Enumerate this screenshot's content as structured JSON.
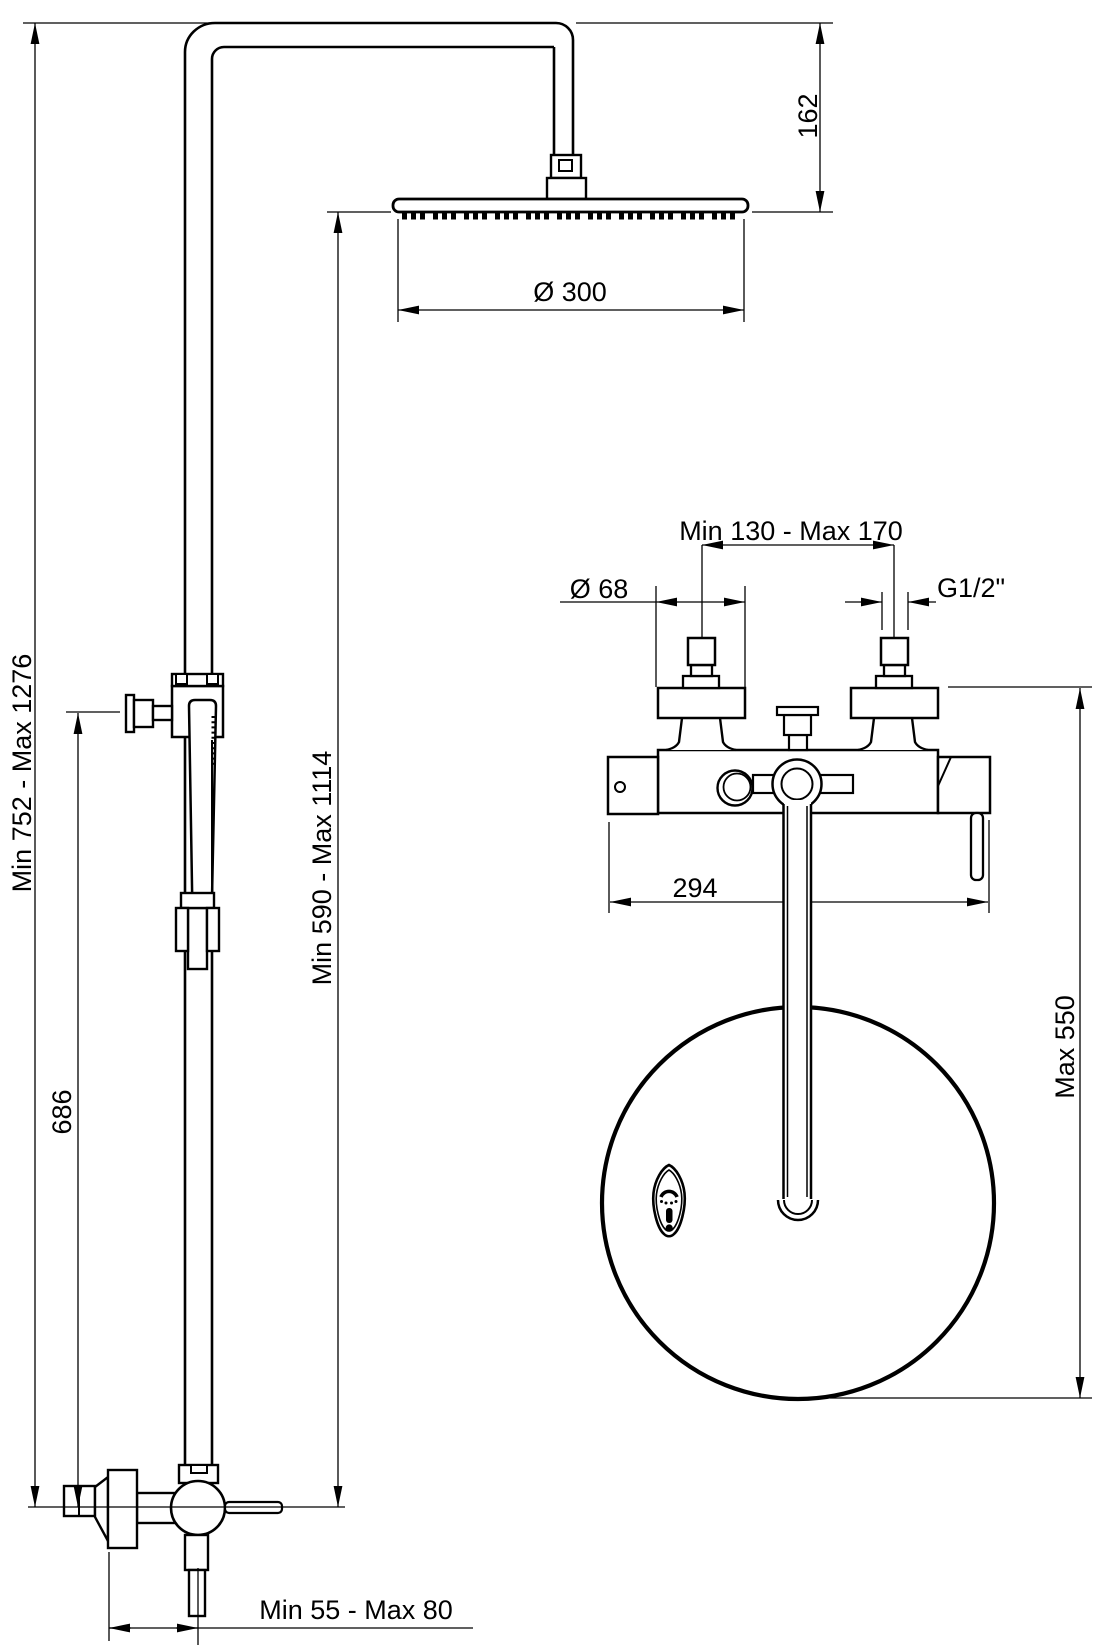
{
  "diagram": {
    "type": "technical-dimension-drawing",
    "subject": "shower column with overhead shower, hand shower and wall-mounted thermostatic bath mixer",
    "line_color": "#000000",
    "background_color": "#ffffff",
    "labels": {
      "head_drop_height": "162",
      "head_diameter": "Ø 300",
      "column_total_height": "Min 752 - Max 1276",
      "handshower_holder_height": "686",
      "head_to_wall_outlet": "Min 590 - Max 1114",
      "inlet_center_distance": "Min 130 - Max 170",
      "escutcheon_diameter": "Ø 68",
      "inlet_thread": "G1/2\"",
      "mixer_body_width": "294",
      "hose_hanging_length": "Max 550",
      "outlet_wall_offset": "Min 55 - Max 80"
    }
  }
}
